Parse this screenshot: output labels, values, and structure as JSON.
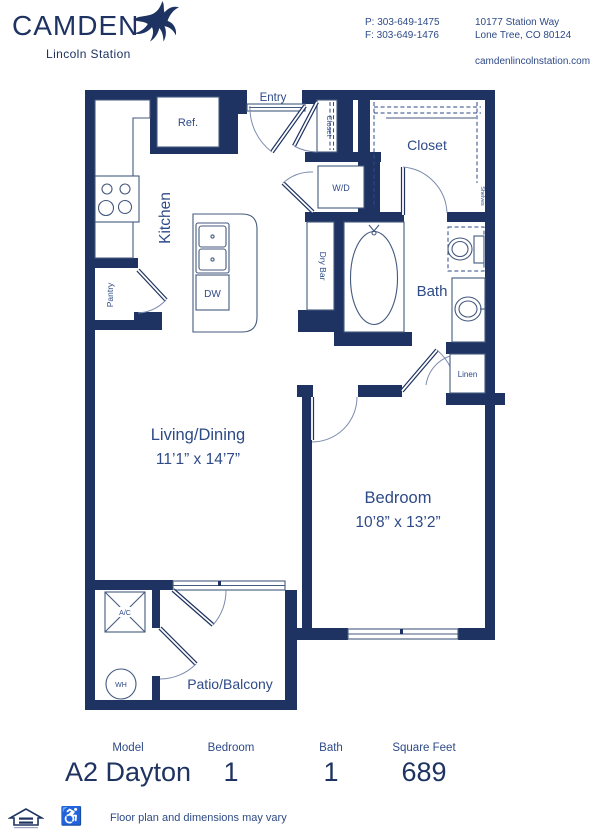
{
  "header": {
    "brand": "CAMDEN",
    "brand_sub": "Lincoln Station",
    "contact": {
      "phone": "P: 303-649-1475",
      "fax": "F: 303-649-1476",
      "address1": "10177 Station Way",
      "address2": "Lone Tree, CO 80124",
      "website": "camdenlincolnstation.com"
    }
  },
  "plan": {
    "entry": "Entry",
    "kitchen": "Kitchen",
    "ref": "Ref.",
    "dw": "DW",
    "pantry": "Pantry",
    "entry_closet": "Closet",
    "wd": "W/D",
    "closet": "Closet",
    "shelves": "Shelves",
    "dry_bar": "Dry Bar",
    "bath": "Bath",
    "linen": "Linen",
    "living_name": "Living/Dining",
    "living_dims": "11’1” x 14’7”",
    "bedroom_name": "Bedroom",
    "bedroom_dims": "10’8” x 13’2”",
    "patio": "Patio/Balcony",
    "ac": "A/C",
    "wh": "WH"
  },
  "summary": {
    "columns": [
      {
        "label": "Model",
        "value": "A2 Dayton"
      },
      {
        "label": "Bedroom",
        "value": "1"
      },
      {
        "label": "Bath",
        "value": "1"
      },
      {
        "label": "Square Feet",
        "value": "689"
      }
    ]
  },
  "footer": {
    "disclaimer": "Floor plan and dimensions may vary"
  },
  "colors": {
    "navy": "#1e3361",
    "label_blue": "#2e4a87"
  }
}
